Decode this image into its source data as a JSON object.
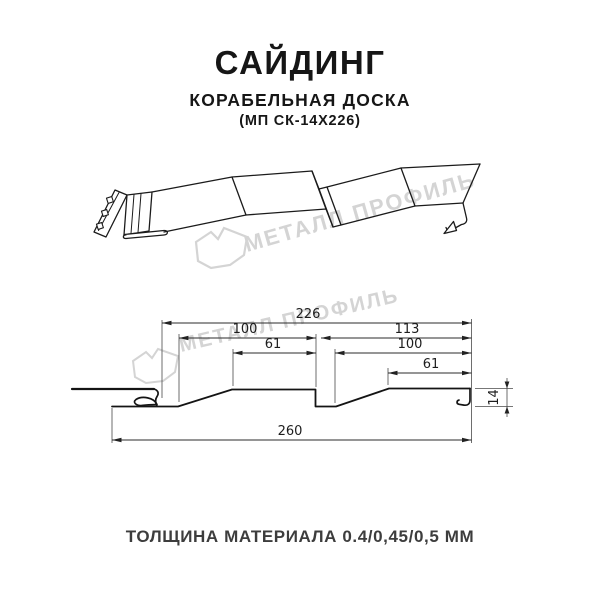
{
  "header": {
    "title": "САЙДИНГ",
    "subtitle": "КОРАБЕЛЬНАЯ ДОСКА",
    "model": "(МП СК-14Х226)"
  },
  "watermark": {
    "brand": "МЕТАЛЛ ПРОФИЛЬ",
    "color": "#d4d4d4"
  },
  "section": {
    "dimensions": {
      "overall_top": "226",
      "pitch_left": "100",
      "pitch_right": "113",
      "flat_left": "61",
      "pitch_right_inner": "100",
      "flat_right": "61",
      "overall_bottom": "260",
      "height": "14"
    }
  },
  "footer": {
    "thickness": "ТОЛЩИНА МАТЕРИАЛА 0.4/0,45/0,5 ММ"
  },
  "colors": {
    "line": "#1b1b1b",
    "dim": "#2b2b2b"
  }
}
